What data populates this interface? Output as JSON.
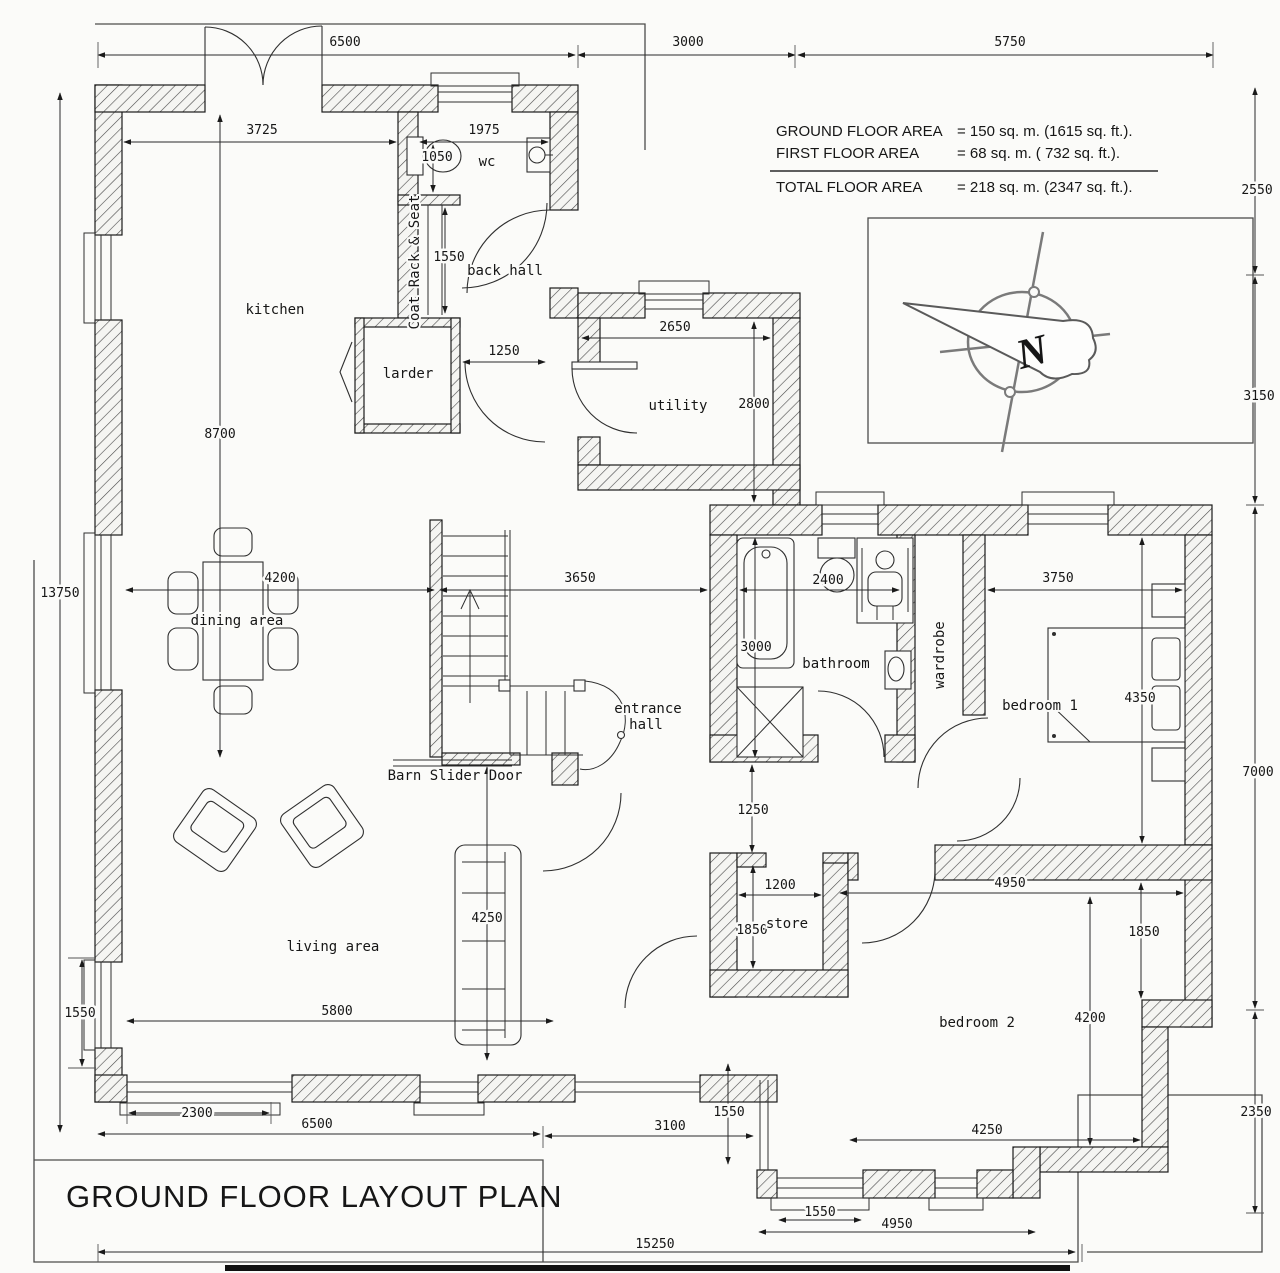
{
  "title": "GROUND FLOOR LAYOUT PLAN",
  "header": {
    "area_table": {
      "rows": [
        {
          "label": "GROUND FLOOR AREA",
          "value": "=  150 sq. m. (1615 sq. ft.)."
        },
        {
          "label": "FIRST FLOOR AREA",
          "value": "=   68 sq. m. (  732 sq. ft.)."
        },
        {
          "label": "TOTAL FLOOR AREA",
          "value": "=  218 sq. m. (2347 sq. ft.)."
        }
      ]
    },
    "north_label": "N"
  },
  "rooms": {
    "kitchen": "kitchen",
    "wc": "wc",
    "back_hall": "back hall",
    "larder": "larder",
    "utility": "utility",
    "dining": "dining area",
    "entrance_line1": "entrance",
    "entrance_line2": "hall",
    "living": "living area",
    "bathroom": "bathroom",
    "wardrobe": "wardrobe",
    "bedroom1": "bedroom 1",
    "store": "store",
    "bedroom2": "bedroom 2"
  },
  "annotations": {
    "coat_rack": "Coat Rack & Seat",
    "barn_door": "Barn Slider Door"
  },
  "dimensions": {
    "top_6500": "6500",
    "top_3000": "3000",
    "top_5750": "5750",
    "kitchen_3725": "3725",
    "wc_1975": "1975",
    "wc_1050": "1050",
    "coat_1550": "1550",
    "larder_1250": "1250",
    "utility_2650": "2650",
    "utility_2800": "2800",
    "kitchen_8700": "8700",
    "left_13750": "13750",
    "dining_4200": "4200",
    "hall_3650": "3650",
    "bath_2400": "2400",
    "bath_3000": "3000",
    "bed1_3750": "3750",
    "bed1_4350": "4350",
    "right_2550": "2550",
    "right_3150": "3150",
    "right_7000": "7000",
    "right_2350": "2350",
    "hall_1250": "1250",
    "store_1200": "1200",
    "store_1850": "1850",
    "bed2_4950": "4950",
    "bed2_1850": "1850",
    "bed2_4200": "4200",
    "bed2_4250": "4250",
    "living_4250": "4250",
    "living_5800": "5800",
    "window_1550": "1550",
    "window_2300": "2300",
    "bottom_6500": "6500",
    "bottom_3100": "3100",
    "corridor_1550": "1550",
    "bay_1550": "1550",
    "bay_4950": "4950",
    "total_15250": "15250"
  }
}
